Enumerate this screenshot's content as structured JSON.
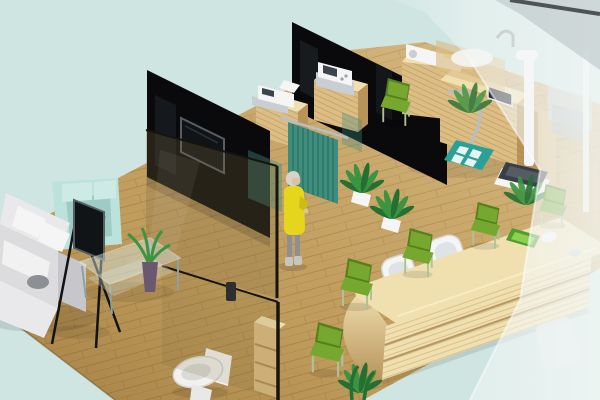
{
  "meta": {
    "type": "3d-isometric-interior-render",
    "description": "Isometric 3D rendering of a small clinic / office floor plan with waiting lounge, glass-partitioned consultation rooms, exam corner with scale, bathroom and reception counter",
    "visible_text": []
  },
  "scene": {
    "zones": [
      {
        "id": "lounge",
        "label": "waiting lounge",
        "items": [
          "l-shaped white sofa with cushions",
          "teal armchair",
          "flat tv on black easel stand",
          "glass coffee table",
          "aloe plant in purple vase",
          "gray bowl on chaise"
        ]
      },
      {
        "id": "consult-room",
        "label": "consultation room behind black glass walls",
        "items": [
          "black partition wall with mounted tv",
          "tinted glass pane",
          "teal reflection panels"
        ]
      },
      {
        "id": "equipment-bay",
        "label": "device cabinets",
        "items": [
          "wood cabinet with white printer",
          "wood cabinet with white fax device"
        ]
      },
      {
        "id": "triage",
        "label": "curtained triage corner",
        "items": [
          "teal privacy curtain on chrome rail",
          "two potted plants",
          "green side chair"
        ]
      },
      {
        "id": "exam-corner",
        "label": "examination corner",
        "items": [
          "l-shaped wooden exam desk",
          "white imaging device",
          "small dark screen device",
          "chrome hose",
          "teal mat with white tiles",
          "white stadiometer pole",
          "dark weighing scale",
          "wooden side column"
        ]
      },
      {
        "id": "bathroom",
        "label": "bathroom behind glass",
        "items": [
          "white toilet",
          "wooden shelf column",
          "glass pane with dark handle"
        ]
      },
      {
        "id": "reception",
        "label": "reception & waiting row",
        "items": [
          "long rounded wooden counter",
          "two white office chairs",
          "green mail tray",
          "white mouse-like object",
          "five green waiting chairs",
          "floor plant",
          "counter-side greenery"
        ]
      },
      {
        "id": "glazed-right",
        "label": "frosted glass wing",
        "items": [
          "frosted glass wall panes",
          "ghost sink counter with faucet",
          "ghost plant",
          "gray equipment boxes",
          "ghost white chair",
          "thin white pole",
          "dark wall top edge"
        ]
      }
    ],
    "people": [
      {
        "id": "visitor",
        "description": "woman with gray hair in yellow dress standing at the curtain"
      }
    ]
  },
  "colors": {
    "background": "#cfe5e2",
    "background_corner": "#e9f3f1",
    "floor": "#c8a464",
    "floor_line": "#96722f",
    "floor_edge": "#6b4c16",
    "black_wall": "#0a0a0c",
    "wall_streak": "#323b43",
    "wood": "#dcbd84",
    "wood_dark": "#b8935a",
    "wood_top": "#f0e0b0",
    "wood_grain": "#a8854d",
    "glass_tint": "#7a6a3c",
    "glass_edge": "#16140f",
    "frosted": "#f4f8f7",
    "frosted_dark": "#aeb6b8",
    "wall_top_edge": "#4e5456",
    "curtain": "#3e8d7d",
    "curtain_dark": "#2b6a5c",
    "chair_green": "#76a82f",
    "chair_green_dark": "#567f1e",
    "chair_leg": "#aec29a",
    "sofa": "#e9e9eb",
    "sofa_mid": "#dcdcdf",
    "sofa_dark": "#c7c7cb",
    "armchair": "#bce2dc",
    "armchair_dark": "#9cccc4",
    "white": "#f4f5f4",
    "device_gray": "#c9ced2",
    "tv_screen": "#111417",
    "tv_frame": "#565e64",
    "metal": "#b6bfc4",
    "plant": "#3c9440",
    "plant_dark": "#247032",
    "mat": "#2aa198",
    "mat_tile": "#e8f4f2",
    "woman_dress": "#e5d51c",
    "woman_hair": "#d8d3c9",
    "woman_skin": "#d9c3a8",
    "woman_legs": "#8f8f93",
    "scale_dark": "#3a3f45",
    "tray_green": "#4f9c33",
    "tray_inner": "#8fcf4e",
    "vase_purple": "#6b5870"
  }
}
